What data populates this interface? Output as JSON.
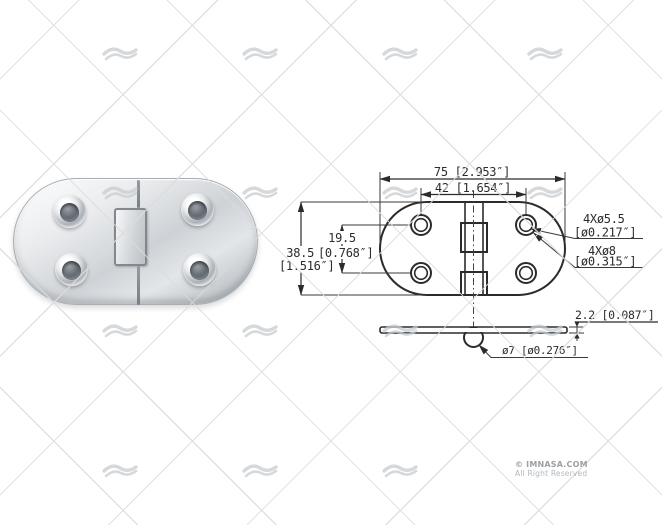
{
  "page": {
    "background": "#ffffff"
  },
  "watermark": {
    "icon": "imnasa-wave-logo",
    "color": "#c9cdd1"
  },
  "drawing": {
    "top_view": {
      "width_label": "75 [2.953″]",
      "hole_pitch_label": "42 [1.654″]",
      "height_mm": "38.5",
      "height_in": "[1.516″]",
      "pitch_v_mm": "19.5",
      "pitch_v_in": "[0.768″]",
      "hole_small_qty": "4Xø5.5",
      "hole_small_in": "[ø0.217″]",
      "hole_large_qty": "4Xø8",
      "hole_large_in": "[ø0.315″]"
    },
    "side_view": {
      "thickness_label": "2.2 [0.087″]",
      "knuckle_label": "ø7 [ø0.276″]"
    }
  },
  "footer": {
    "copyright": "© IMNASA.COM",
    "rights": "All Right Reserved"
  }
}
